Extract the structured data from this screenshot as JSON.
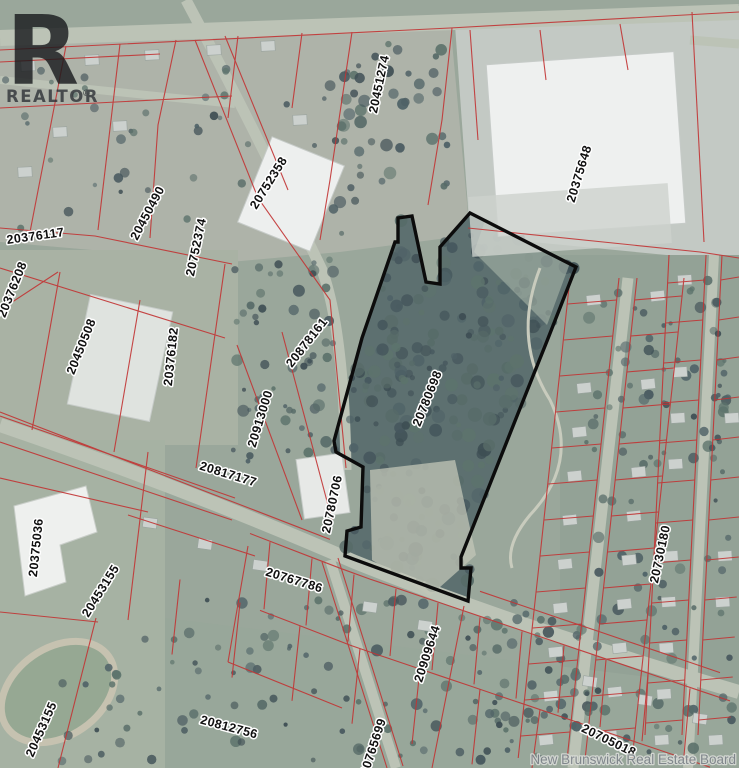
{
  "branding": {
    "logo_letter": "R",
    "logo_text": "REALTOR",
    "registered_mark": "®",
    "board_watermark": "New Brunswick  Real Estate Board"
  },
  "map": {
    "type": "aerial-parcel-map",
    "subject_parcel_id": "20780698",
    "colors": {
      "parcel_line": "#c23434",
      "subject_outline": "#0c0c0c"
    },
    "parcels": [
      {
        "id": "20451274"
      },
      {
        "id": "20752358"
      },
      {
        "id": "20375648"
      },
      {
        "id": "20376117"
      },
      {
        "id": "20450490"
      },
      {
        "id": "20752374"
      },
      {
        "id": "20376208"
      },
      {
        "id": "20450508"
      },
      {
        "id": "20376182"
      },
      {
        "id": "20878161"
      },
      {
        "id": "20780698"
      },
      {
        "id": "20913000"
      },
      {
        "id": "20817177"
      },
      {
        "id": "20780706"
      },
      {
        "id": "20375036"
      },
      {
        "id": "20453155"
      },
      {
        "id": "20767786"
      },
      {
        "id": "20730180"
      },
      {
        "id": "20909644"
      },
      {
        "id": "20812756"
      },
      {
        "id": "20765699"
      },
      {
        "id": "20705018"
      },
      {
        "id": "20453155"
      }
    ]
  }
}
